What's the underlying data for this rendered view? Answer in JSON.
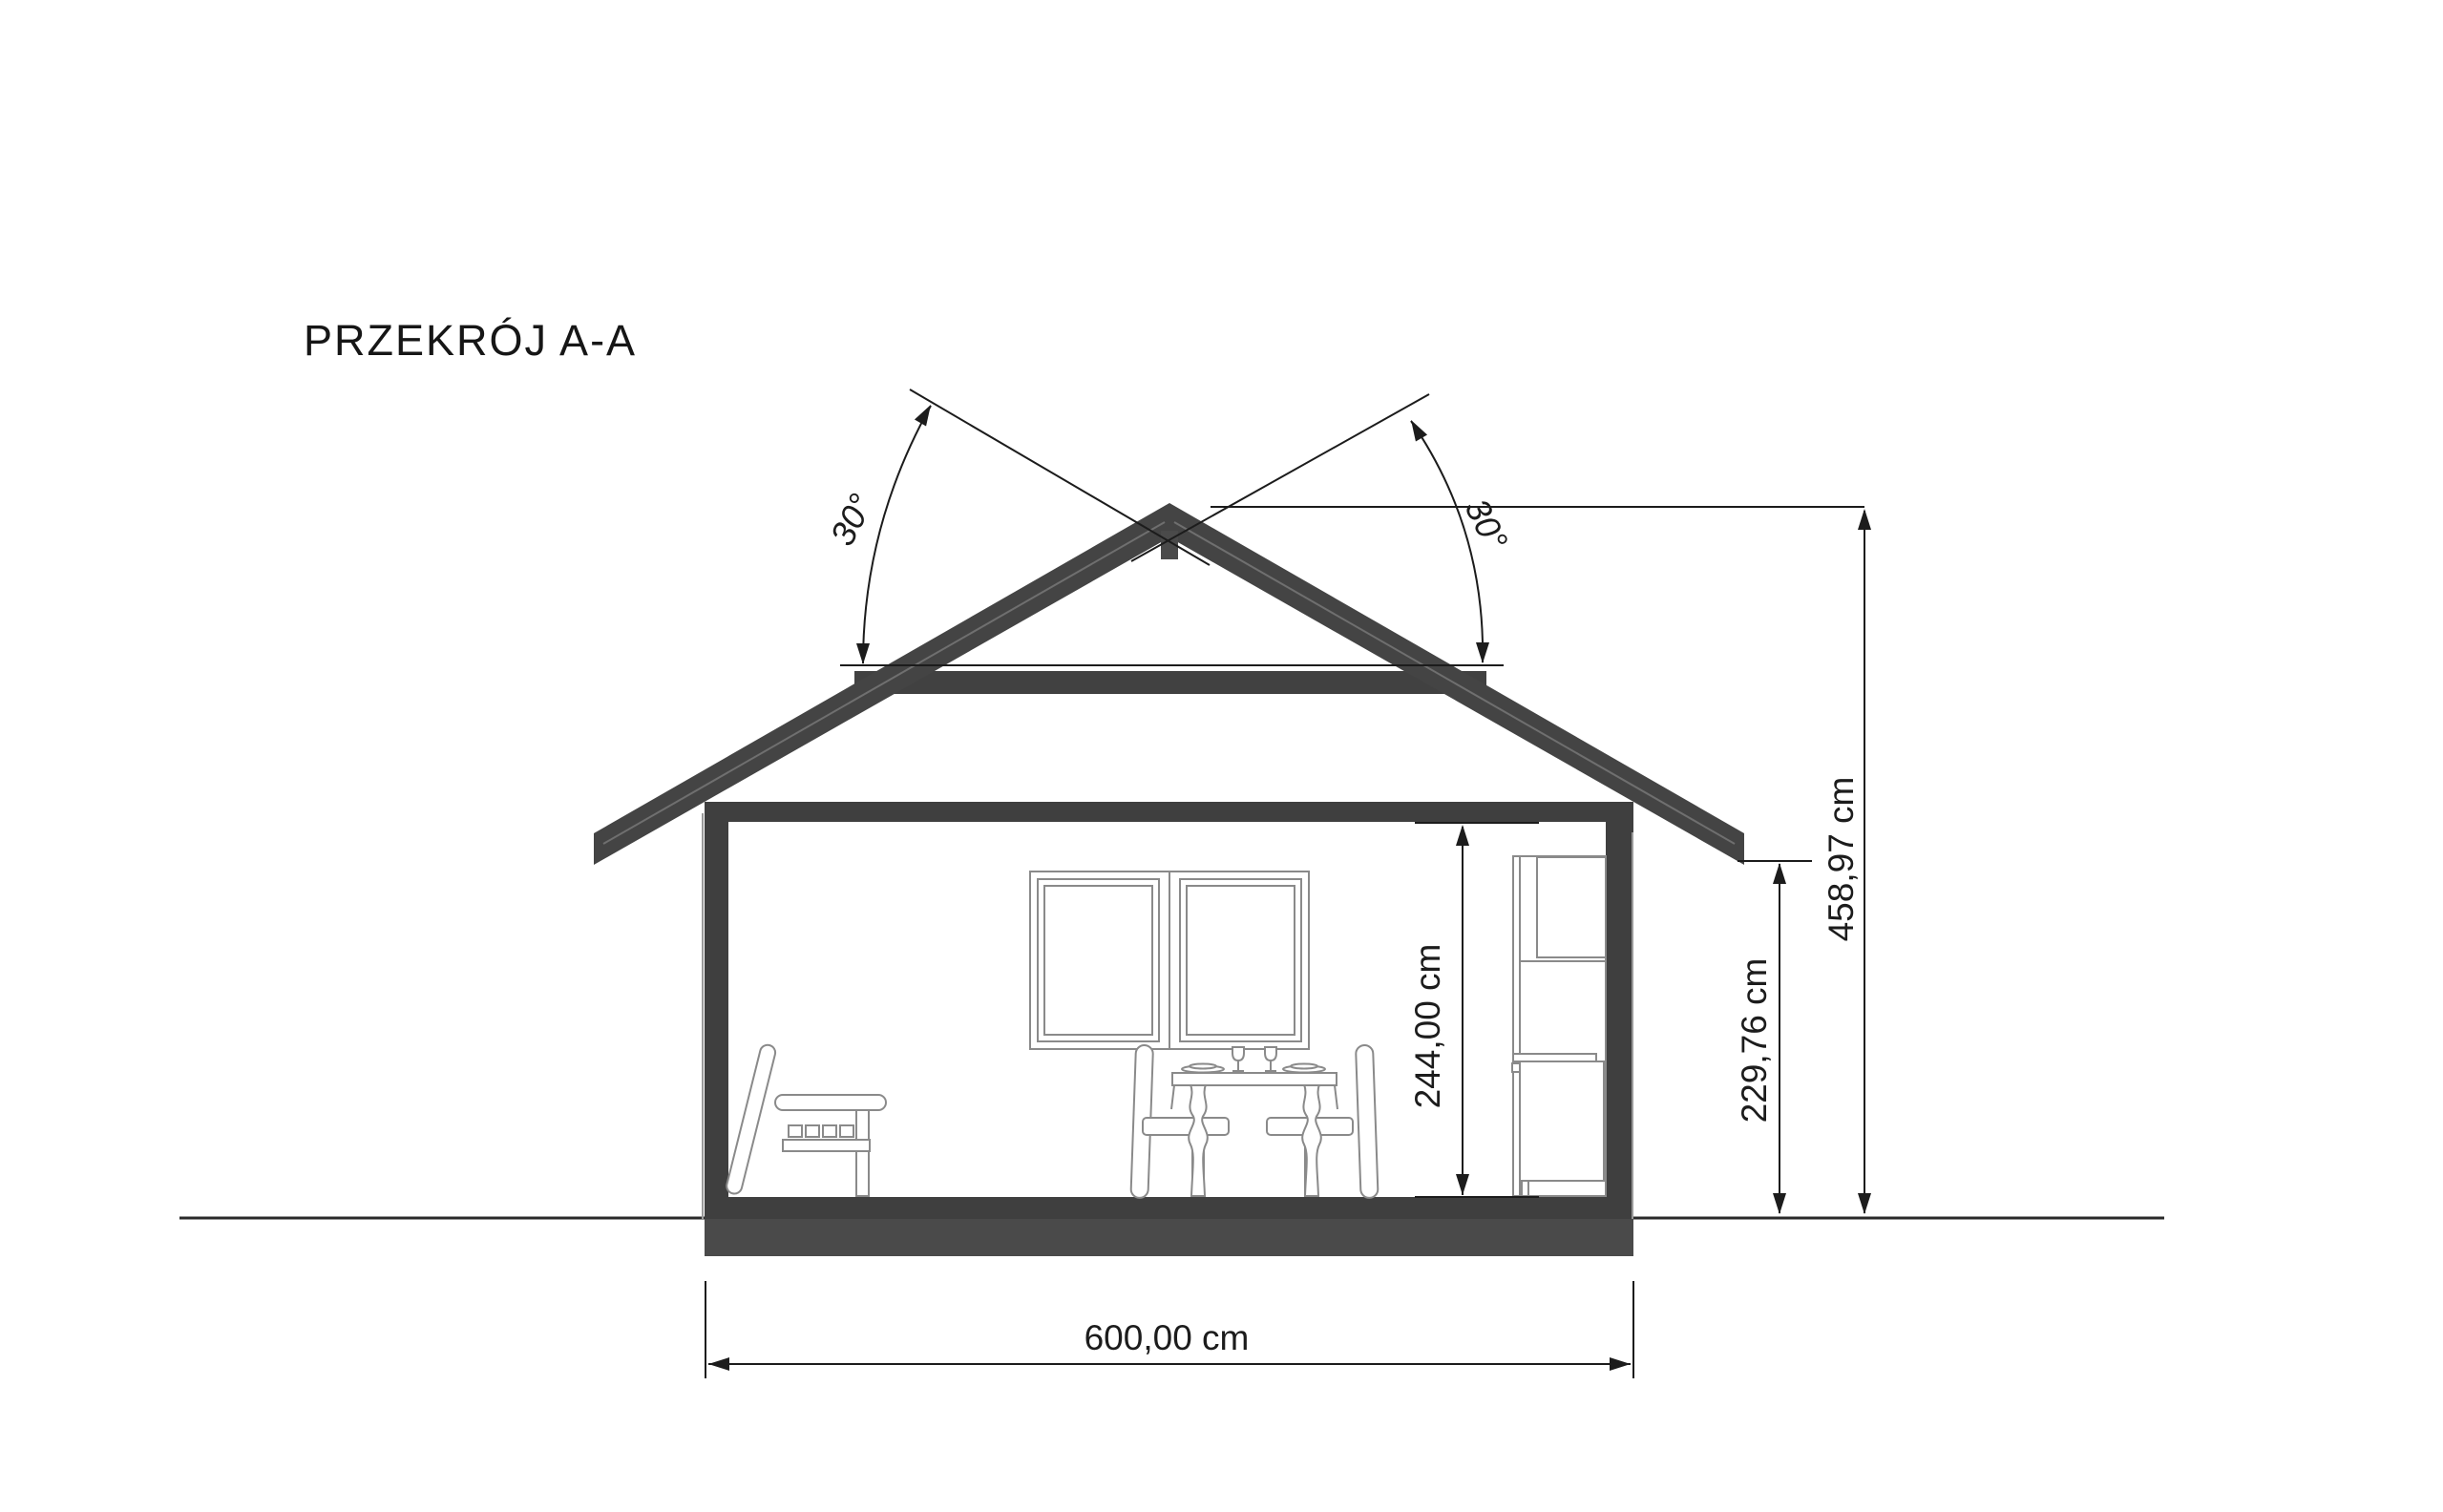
{
  "title": "PRZEKRÓJ A-A",
  "drawing_type": "architectural-cross-section",
  "labels": {
    "width": "600,00 cm",
    "interior_height": "244,00 cm",
    "wall_height": "229,76 cm",
    "total_height": "458,97 cm",
    "angle_left": "30°",
    "angle_right": "30°"
  },
  "colors": {
    "background": "#ffffff",
    "structure_dark": "#3f3f3f",
    "roof_dark": "#444444",
    "foundation": "#4a4a4a",
    "furniture_outline": "#8a8a8a",
    "dimension_line": "#1c1c1c"
  }
}
